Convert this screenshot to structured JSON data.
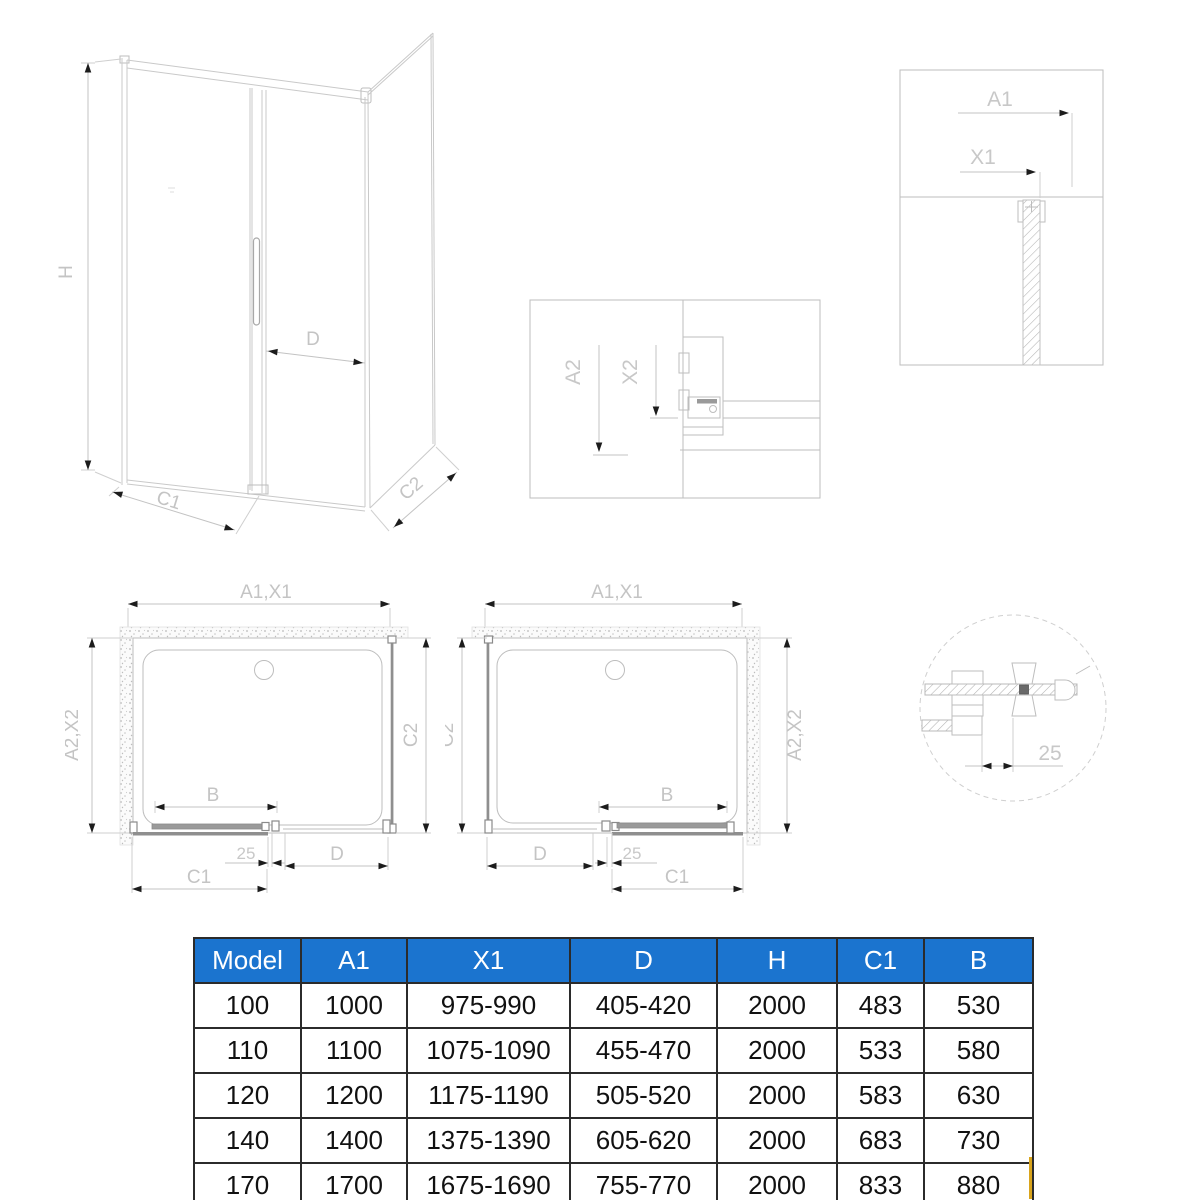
{
  "perspective": {
    "h": "H",
    "d": "D",
    "c1": "C1",
    "c2": "C2"
  },
  "detail_top_right": {
    "a1": "A1",
    "x1": "X1"
  },
  "detail_roller": {
    "a2": "A2",
    "x2": "X2"
  },
  "plan_left": {
    "width": "A1,X1",
    "depth": "A2,X2",
    "side": "C2",
    "door_glass": "B",
    "adjust": "25",
    "opening": "D",
    "slide": "C1"
  },
  "plan_right": {
    "width": "A1,X1",
    "side": "C2",
    "depth": "A2,X2",
    "opening": "D",
    "adjust": "25",
    "door_glass": "B",
    "slide": "C1"
  },
  "wall_detail": {
    "adjust": "25"
  },
  "table": {
    "columns": [
      "Model",
      "A1",
      "X1",
      "D",
      "H",
      "C1",
      "B"
    ],
    "rows": [
      [
        "100",
        "1000",
        "975-990",
        "405-420",
        "2000",
        "483",
        "530"
      ],
      [
        "110",
        "1100",
        "1075-1090",
        "455-470",
        "2000",
        "533",
        "580"
      ],
      [
        "120",
        "1200",
        "1175-1190",
        "505-520",
        "2000",
        "583",
        "630"
      ],
      [
        "140",
        "1400",
        "1375-1390",
        "605-620",
        "2000",
        "683",
        "730"
      ],
      [
        "170",
        "1700",
        "1675-1690",
        "755-770",
        "2000",
        "833",
        "880"
      ]
    ]
  },
  "colors": {
    "header_bg": "#1b74cf",
    "header_text": "#ffffff",
    "table_border": "#2b2b2b",
    "drawing_line": "#c9c9c9",
    "arrow": "#1c1c1c",
    "accent_gold": "#d9a41c"
  }
}
